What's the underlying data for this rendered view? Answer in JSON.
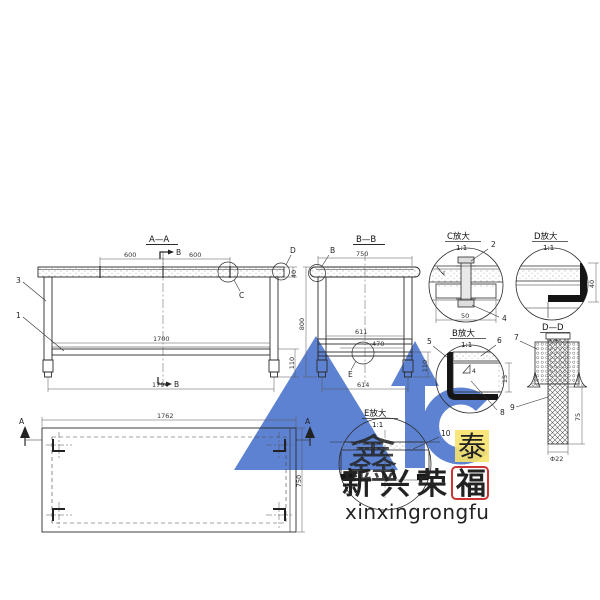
{
  "watermark": {
    "brand_cn": [
      "新",
      "兴",
      "荣",
      "福"
    ],
    "brand_pinyin": "xinxingrongfu",
    "seal_left": "鑫",
    "seal_right": "泰",
    "logo_color": "#3a67c8",
    "brand_red": "#cf3434",
    "pinyin_color": "#a9c2d6",
    "gold": "#d9a61d"
  },
  "front_view": {
    "title": "A—A",
    "section_marker": "B",
    "part_labels": {
      "frame": "3",
      "shelf": "1"
    },
    "detail_circles": {
      "c": "C",
      "d": "D"
    },
    "dims": {
      "top_left": "600",
      "top_right": "600",
      "shelf_length": "1700",
      "overall_length": "1794",
      "top_thickness": "40",
      "foot_height": "110"
    }
  },
  "side_view": {
    "title": "B—B",
    "detail_circles": {
      "b": "B",
      "e": "E"
    },
    "dims": {
      "top_width": "750",
      "overall_height": "800",
      "rail_upper": "611",
      "rail_lower": "470",
      "bottom_width": "614",
      "foot_height": "110"
    }
  },
  "plan_view": {
    "section_marker": "A",
    "dims": {
      "length": "1762",
      "depth": "750"
    }
  },
  "detail_c": {
    "title": "C放大",
    "scale": "1:1",
    "part_bolt": "2",
    "part_nut": "4",
    "dim_width": "50"
  },
  "detail_d": {
    "title": "D放大",
    "scale": "1:1",
    "dim_height": "40"
  },
  "detail_b": {
    "title": "B放大",
    "scale": "1:1",
    "part_angle": "5",
    "part_top": "6",
    "part_channel": "8",
    "weld_size": "4",
    "dim_height": "15"
  },
  "section_dd": {
    "title": "D—D",
    "scale": "1:2",
    "part_leg": "7",
    "part_foot": "9",
    "dim_height": "75",
    "dim_diameter": "Φ22"
  },
  "detail_e": {
    "title": "E放大",
    "scale": "1:1",
    "part_rail": "10"
  }
}
